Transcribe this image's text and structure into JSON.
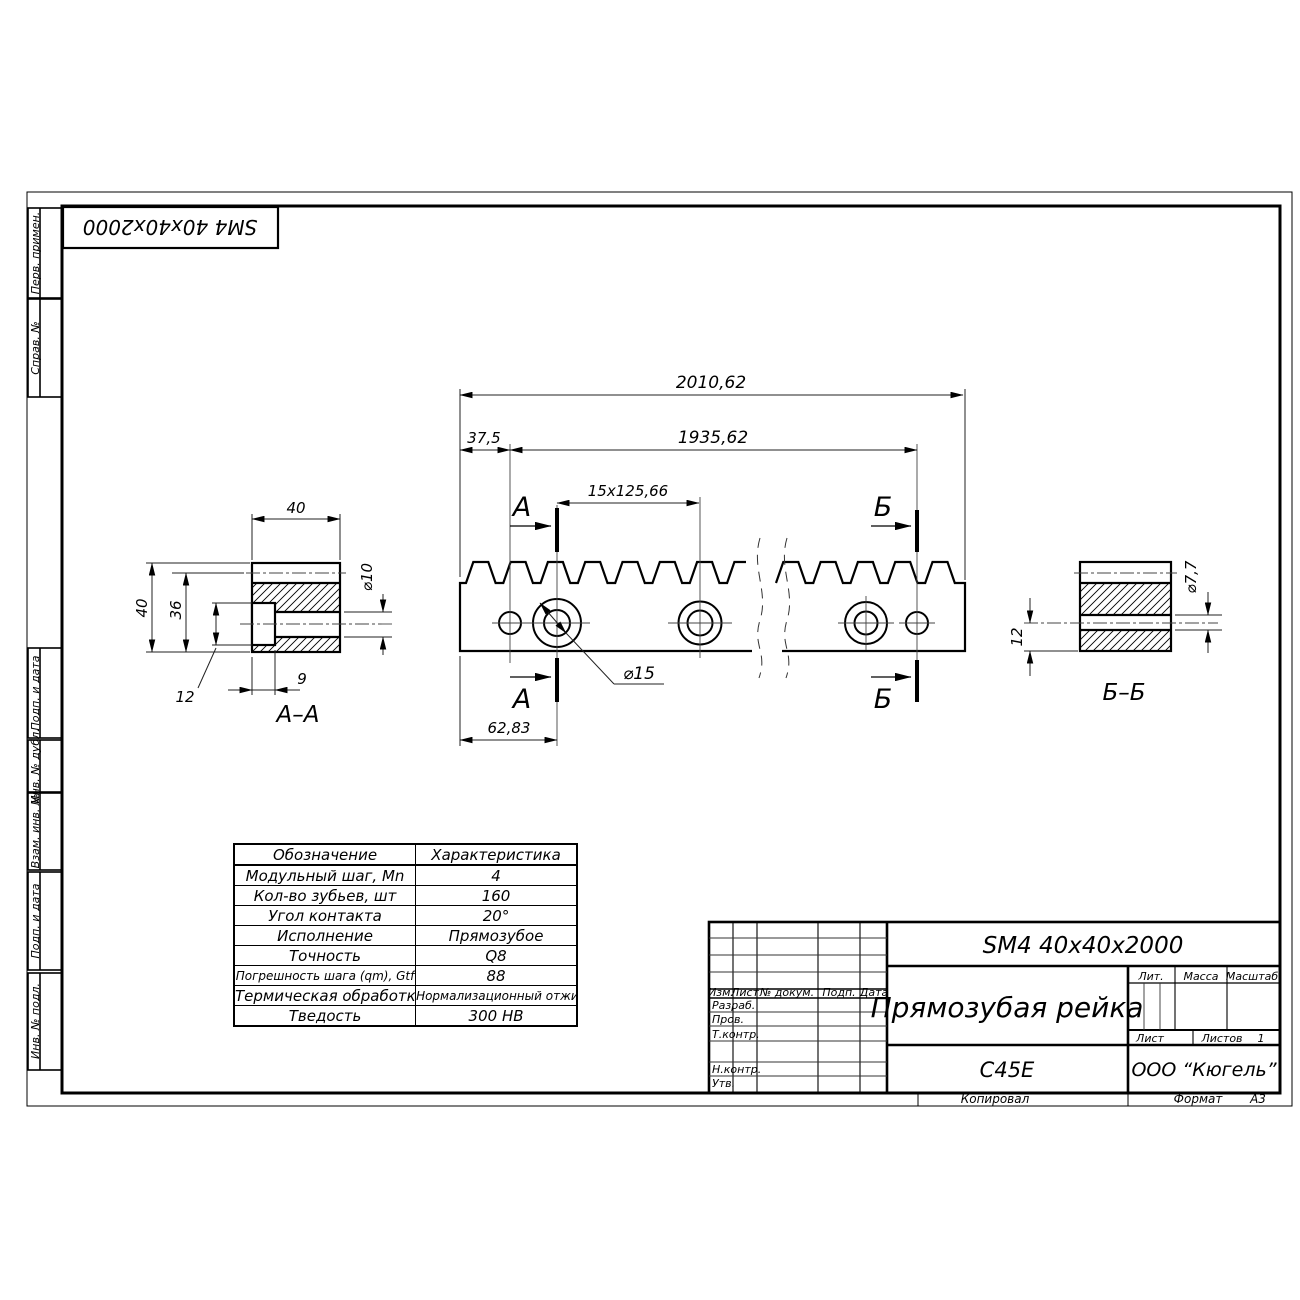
{
  "sheet": {
    "top_stamp": "SM4 40x40x2000",
    "margin_fields": [
      "Перв. примен.",
      "Справ. №",
      "Подп. и дата",
      "Инв. № дубл.",
      "Взам. инв. №",
      "Подп. и дата",
      "Инв. № подл."
    ],
    "footer": {
      "copied_by": "Копировал",
      "format_label": "Формат",
      "format_value": "А3"
    }
  },
  "views": {
    "main": {
      "dim_total": "2010,62",
      "dim_offset": "37,5",
      "dim_span": "1935,62",
      "dim_pitch": "15x125,66",
      "dim_first_hole": "62,83",
      "dim_hole_dia": "⌀15",
      "cut_label_a": "А",
      "cut_label_b": "Б"
    },
    "section_aa": {
      "title": "А–А",
      "dim_width": "40",
      "dim_height": "40",
      "dim_36": "36",
      "dim_12": "12",
      "dim_9": "9",
      "dim_dia": "⌀10"
    },
    "section_bb": {
      "title": "Б–Б",
      "dim_12": "12",
      "dim_dia": "⌀7,7"
    }
  },
  "params_table": {
    "col_headers": [
      "Обозначение",
      "Характеристика"
    ],
    "rows": [
      [
        "Модульный шаг, Mn",
        "4"
      ],
      [
        "Кол-во зубьев, шт",
        "160"
      ],
      [
        "Угол контакта",
        "20°"
      ],
      [
        "Исполнение",
        "Прямозубое"
      ],
      [
        "Точность",
        "Q8"
      ],
      [
        "Погрешность шага (qm), Gtf",
        "88"
      ],
      [
        "Термическая обработка",
        "Нормализационный отжиг"
      ],
      [
        "Тведость",
        "300 HB"
      ]
    ]
  },
  "title_block": {
    "designation": "SM4 40x40x2000",
    "part_name": "Прямозубая рейка",
    "material": "C45E",
    "company": "ООО “Кюгель”",
    "header_cols": [
      "Изм.",
      "Лист",
      "№ докум.",
      "Подп.",
      "Дата"
    ],
    "row_labels": [
      "Разраб.",
      "Пров.",
      "Т.контр.",
      "Н.контр.",
      "Утв."
    ],
    "lit_label": "Лит.",
    "mass_label": "Масса",
    "scale_label": "Масштаб",
    "sheet_label": "Лист",
    "sheets_label": "Листов",
    "sheets_value": "1"
  }
}
